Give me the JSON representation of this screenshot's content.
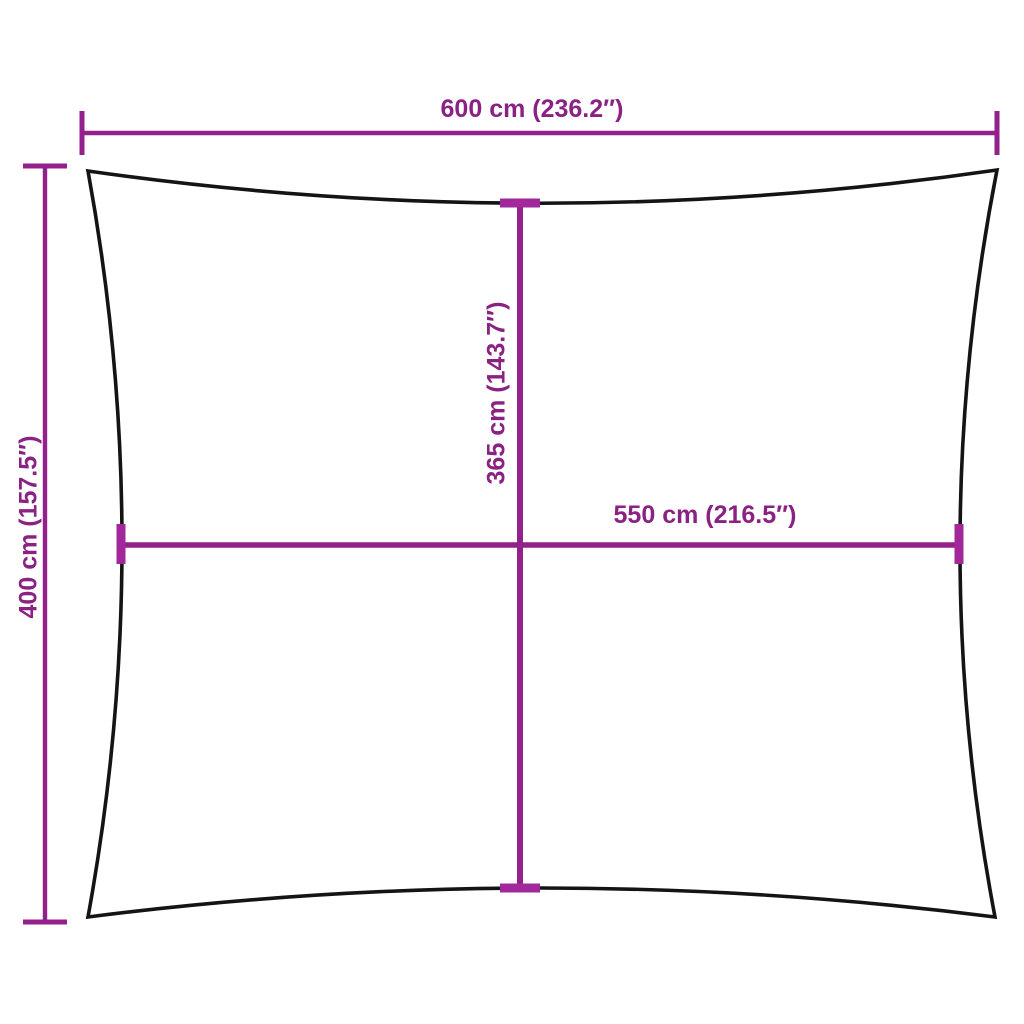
{
  "labels": {
    "top_width": "600 cm (236.2″)",
    "left_height": "400 cm (157.5″)",
    "center_height": "365 cm (143.7″)",
    "center_width": "550 cm (216.5″)"
  },
  "colors": {
    "dimension_line": "#93208B",
    "dimension_text": "#8A2284",
    "center_tick": "#A2279A",
    "outline": "#141414",
    "background": "#FFFFFF"
  }
}
